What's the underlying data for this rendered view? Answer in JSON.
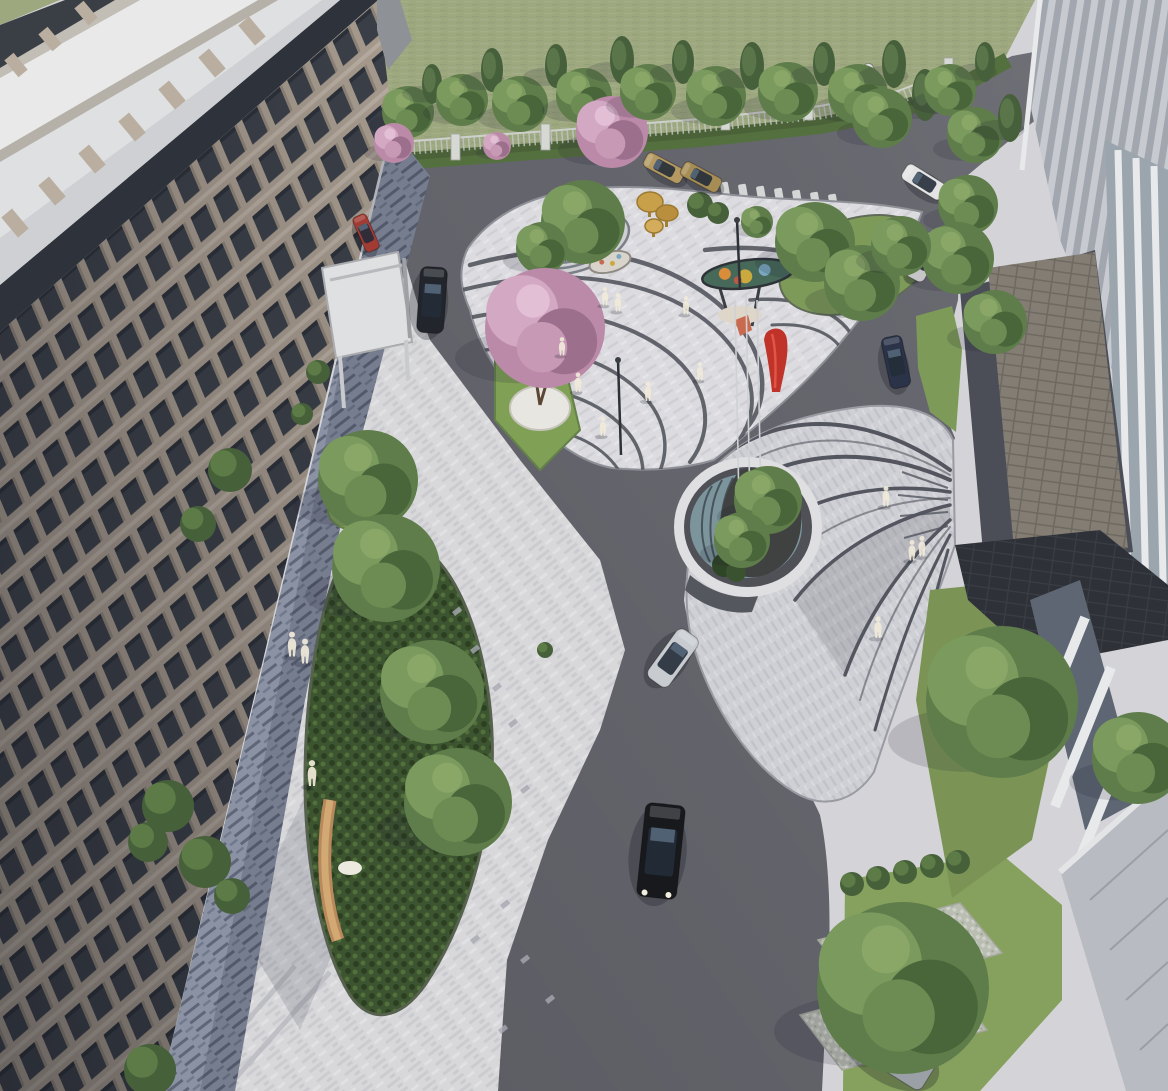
{
  "meta": {
    "title": "Aerial architectural rendering of residential courtyard landscape",
    "width": 1168,
    "height": 1091
  },
  "palette": {
    "asphalt": "#66666e",
    "asphalt_dark": "#5b5b63",
    "paving_light": "#d8d8db",
    "plaza_light": "#dcdbdf",
    "fan_paving": "#cfd0d5",
    "stripe_dark": "#4d4f58",
    "walkway": "#8a92a4",
    "walkway_stripe": "#5f6678",
    "grass_field": "#9da87f",
    "lawn": "#7d9a58",
    "hedge": "#55703f",
    "fern": "#3d5430",
    "water": "#7c949c",
    "pond_ring": "#4f5157",
    "pond_ring_light": "#dfdfe2",
    "facade_frame": "#a79b8e",
    "facade_window": "#3b3f47",
    "parapet": "#2e323a",
    "rooftop_white": "#e9e9ea",
    "rooftop_deck": "#dfe0e2",
    "deck_edge": "#b5b1a9",
    "annex_roof": "#8e9196",
    "right_facade_a": "#c7cad0",
    "right_facade_b": "#a2a7af",
    "glass": "#9aa5ae",
    "canopy_tile": "#837d74",
    "canopy_dark": "#4b4e56",
    "roof_wedge": "#2c2f35",
    "column_white": "#e8e9eb",
    "base_paving": "#b8bbc1",
    "grass_paver": "#b9bdb2",
    "wood_bench": "#b8895c",
    "wood_bench_top": "#d2a873",
    "sculpture_red": "#bf332a",
    "sculpture_red_hi": "#e05545",
    "mushroom_gold": "#c9a04a",
    "mural_teal": "#46695a",
    "figure_white": "#f0ead9",
    "tree_mid": "#5f7d4a",
    "tree_light": "#7b9a5e",
    "tree_dark": "#49653a",
    "tree_extra": "#6d8c53",
    "conifer": "#47603c",
    "conifer_light": "#5a7549",
    "blossom_base": "#bb8aa8",
    "blossom_light": "#d2a8c2",
    "blossom_dark": "#9c6f8d",
    "blossom_extra": "#c799b5"
  },
  "scene": {
    "trees": [
      {
        "x": 408,
        "y": 112,
        "r": 26,
        "kind": "round"
      },
      {
        "x": 432,
        "y": 84,
        "r": 20,
        "kind": "conifer"
      },
      {
        "x": 462,
        "y": 100,
        "r": 26,
        "kind": "round"
      },
      {
        "x": 492,
        "y": 70,
        "r": 22,
        "kind": "conifer"
      },
      {
        "x": 497,
        "y": 146,
        "r": 14,
        "kind": "blossom"
      },
      {
        "x": 520,
        "y": 104,
        "r": 28,
        "kind": "round"
      },
      {
        "x": 556,
        "y": 66,
        "r": 22,
        "kind": "conifer"
      },
      {
        "x": 584,
        "y": 96,
        "r": 28,
        "kind": "round"
      },
      {
        "x": 612,
        "y": 132,
        "r": 36,
        "kind": "blossom"
      },
      {
        "x": 622,
        "y": 60,
        "r": 24,
        "kind": "conifer"
      },
      {
        "x": 648,
        "y": 92,
        "r": 28,
        "kind": "round"
      },
      {
        "x": 683,
        "y": 62,
        "r": 22,
        "kind": "conifer"
      },
      {
        "x": 716,
        "y": 96,
        "r": 30,
        "kind": "round"
      },
      {
        "x": 752,
        "y": 66,
        "r": 24,
        "kind": "conifer"
      },
      {
        "x": 788,
        "y": 92,
        "r": 30,
        "kind": "round"
      },
      {
        "x": 824,
        "y": 64,
        "r": 22,
        "kind": "conifer"
      },
      {
        "x": 858,
        "y": 94,
        "r": 30,
        "kind": "round"
      },
      {
        "x": 894,
        "y": 64,
        "r": 24,
        "kind": "conifer"
      },
      {
        "x": 925,
        "y": 95,
        "r": 26,
        "kind": "conifer"
      },
      {
        "x": 882,
        "y": 118,
        "r": 30,
        "kind": "round"
      },
      {
        "x": 950,
        "y": 90,
        "r": 26,
        "kind": "round"
      },
      {
        "x": 985,
        "y": 62,
        "r": 20,
        "kind": "conifer"
      },
      {
        "x": 975,
        "y": 135,
        "r": 28,
        "kind": "round"
      },
      {
        "x": 1010,
        "y": 118,
        "r": 24,
        "kind": "conifer"
      },
      {
        "x": 968,
        "y": 205,
        "r": 30,
        "kind": "round"
      },
      {
        "x": 958,
        "y": 258,
        "r": 36,
        "kind": "round"
      },
      {
        "x": 995,
        "y": 322,
        "r": 32,
        "kind": "round"
      },
      {
        "x": 583,
        "y": 222,
        "r": 42,
        "kind": "round"
      },
      {
        "x": 542,
        "y": 248,
        "r": 26,
        "kind": "round"
      },
      {
        "x": 757,
        "y": 222,
        "r": 16,
        "kind": "round"
      },
      {
        "x": 815,
        "y": 242,
        "r": 40,
        "kind": "round"
      },
      {
        "x": 862,
        "y": 283,
        "r": 38,
        "kind": "round"
      },
      {
        "x": 901,
        "y": 246,
        "r": 30,
        "kind": "round"
      },
      {
        "x": 545,
        "y": 328,
        "r": 60,
        "kind": "blossom"
      },
      {
        "x": 394,
        "y": 143,
        "r": 20,
        "kind": "blossom"
      },
      {
        "x": 768,
        "y": 500,
        "r": 34,
        "kind": "round"
      },
      {
        "x": 742,
        "y": 540,
        "r": 28,
        "kind": "round"
      },
      {
        "x": 1002,
        "y": 702,
        "r": 76,
        "kind": "round"
      },
      {
        "x": 903,
        "y": 988,
        "r": 86,
        "kind": "round"
      },
      {
        "x": 1138,
        "y": 758,
        "r": 46,
        "kind": "round"
      },
      {
        "x": 368,
        "y": 480,
        "r": 50,
        "kind": "round"
      },
      {
        "x": 386,
        "y": 568,
        "r": 54,
        "kind": "round"
      },
      {
        "x": 432,
        "y": 692,
        "r": 52,
        "kind": "round"
      },
      {
        "x": 458,
        "y": 802,
        "r": 54,
        "kind": "round"
      }
    ],
    "shrubs": [
      {
        "x": 230,
        "y": 470,
        "r": 22
      },
      {
        "x": 198,
        "y": 524,
        "r": 18
      },
      {
        "x": 168,
        "y": 806,
        "r": 26
      },
      {
        "x": 148,
        "y": 842,
        "r": 20
      },
      {
        "x": 205,
        "y": 862,
        "r": 26
      },
      {
        "x": 232,
        "y": 896,
        "r": 18
      },
      {
        "x": 150,
        "y": 1070,
        "r": 26
      },
      {
        "x": 318,
        "y": 372,
        "r": 12
      },
      {
        "x": 302,
        "y": 414,
        "r": 11
      },
      {
        "x": 545,
        "y": 650,
        "r": 8
      },
      {
        "x": 852,
        "y": 884,
        "r": 12
      },
      {
        "x": 878,
        "y": 878,
        "r": 12
      },
      {
        "x": 905,
        "y": 872,
        "r": 12
      },
      {
        "x": 932,
        "y": 866,
        "r": 12
      },
      {
        "x": 958,
        "y": 862,
        "r": 12
      },
      {
        "x": 700,
        "y": 205,
        "r": 13
      },
      {
        "x": 718,
        "y": 213,
        "r": 11
      }
    ],
    "cars": [
      {
        "name": "dark-suv",
        "x": 432,
        "y": 300,
        "rot": 4,
        "len": 66,
        "wid": 27,
        "color": "#22252b"
      },
      {
        "name": "red-car",
        "x": 366,
        "y": 233,
        "rot": -24,
        "len": 38,
        "wid": 15,
        "color": "#a23b33"
      },
      {
        "name": "tan-car-1",
        "x": 664,
        "y": 168,
        "rot": -62,
        "len": 42,
        "wid": 16,
        "color": "#b49a62"
      },
      {
        "name": "tan-car-2",
        "x": 701,
        "y": 177,
        "rot": -62,
        "len": 42,
        "wid": 16,
        "color": "#a68d55"
      },
      {
        "name": "white-van",
        "x": 874,
        "y": 86,
        "rot": -30,
        "len": 46,
        "wid": 18,
        "color": "#dcdcdb"
      },
      {
        "name": "white-parked",
        "x": 924,
        "y": 182,
        "rot": -58,
        "len": 46,
        "wid": 18,
        "color": "#e3e4e3"
      },
      {
        "name": "white-driving",
        "x": 925,
        "y": 257,
        "rot": 28,
        "len": 50,
        "wid": 20,
        "color": "#e6e6e5"
      },
      {
        "name": "navy-sedan",
        "x": 896,
        "y": 362,
        "rot": -12,
        "len": 52,
        "wid": 21,
        "color": "#2a3347"
      },
      {
        "name": "silver-sportscar",
        "x": 673,
        "y": 658,
        "rot": 36,
        "len": 60,
        "wid": 26,
        "color": "#c8ccd1"
      },
      {
        "name": "black-sedan",
        "x": 661,
        "y": 851,
        "rot": 6,
        "len": 94,
        "wid": 40,
        "color": "#17191d",
        "lights": true
      },
      {
        "name": "white-parked-car",
        "x": 927,
        "y": 963,
        "rot": -58,
        "len": 96,
        "wid": 40,
        "color": "#ebebeb"
      },
      {
        "name": "silver-parked-car",
        "x": 888,
        "y": 1048,
        "rot": -58,
        "len": 100,
        "wid": 42,
        "color": "#9aa0a6"
      }
    ],
    "people": [
      {
        "x": 292,
        "y": 645,
        "s": 1.15
      },
      {
        "x": 305,
        "y": 652,
        "s": 1.15
      },
      {
        "x": 312,
        "y": 774,
        "s": 1.2
      },
      {
        "x": 605,
        "y": 297,
        "s": 0.85
      },
      {
        "x": 618,
        "y": 303,
        "s": 0.85
      },
      {
        "x": 562,
        "y": 347,
        "s": 0.85
      },
      {
        "x": 578,
        "y": 383,
        "s": 0.9
      },
      {
        "x": 648,
        "y": 392,
        "s": 0.9
      },
      {
        "x": 686,
        "y": 306,
        "s": 0.85
      },
      {
        "x": 603,
        "y": 427,
        "s": 0.9
      },
      {
        "x": 700,
        "y": 372,
        "s": 0.85
      },
      {
        "x": 886,
        "y": 497,
        "s": 0.95
      },
      {
        "x": 912,
        "y": 551,
        "s": 0.95
      },
      {
        "x": 922,
        "y": 547,
        "s": 0.95
      },
      {
        "x": 878,
        "y": 628,
        "s": 1.0
      }
    ],
    "lamps": [
      {
        "x": 621,
        "y": 455,
        "h": 95
      },
      {
        "x": 740,
        "y": 290,
        "h": 70
      }
    ],
    "pond_poles": [
      [
        735,
        300,
        505
      ],
      [
        746,
        295,
        508
      ],
      [
        757,
        300,
        502
      ]
    ],
    "pavers": [
      [
        452,
        612
      ],
      [
        470,
        650
      ],
      [
        492,
        688
      ],
      [
        438,
        700
      ],
      [
        508,
        724
      ],
      [
        460,
        760
      ],
      [
        430,
        820
      ],
      [
        478,
        838
      ],
      [
        520,
        790
      ],
      [
        500,
        905
      ],
      [
        470,
        940
      ],
      [
        520,
        960
      ],
      [
        545,
        1000
      ],
      [
        498,
        1030
      ]
    ]
  }
}
